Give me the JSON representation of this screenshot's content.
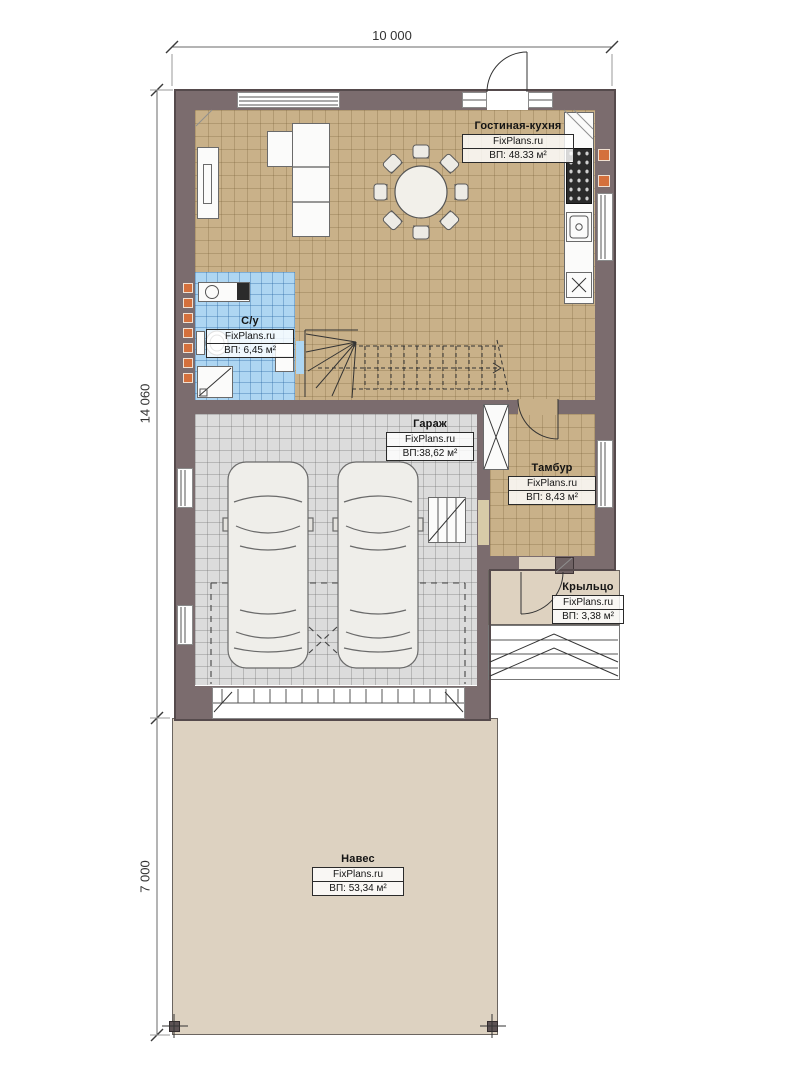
{
  "plan": {
    "dimensions": {
      "width_top": "10 000",
      "height_main": "14 060",
      "height_canopy": "7 000"
    },
    "brand": "FixPlans.ru",
    "rooms": [
      {
        "name": "Гостиная-кухня",
        "area": "ВП: 48.33 м²"
      },
      {
        "name": "С/у",
        "area": "ВП: 6,45 м²"
      },
      {
        "name": "Гараж",
        "area": "ВП:38,62 м²"
      },
      {
        "name": "Тамбур",
        "area": "ВП: 8,43 м²"
      },
      {
        "name": "Крыльцо",
        "area": "ВП: 3,38 м²"
      },
      {
        "name": "Навес",
        "area": "ВП: 53,34 м²"
      }
    ],
    "colors": {
      "wall": "#7b6c6e",
      "floor_living": "#c9b189",
      "floor_bathroom": "#aed6f2",
      "floor_garage": "#dcdcdc",
      "floor_porch": "#ded2c0",
      "canopy": "#ddd2c1",
      "accent_orange": "#d4703c"
    }
  }
}
